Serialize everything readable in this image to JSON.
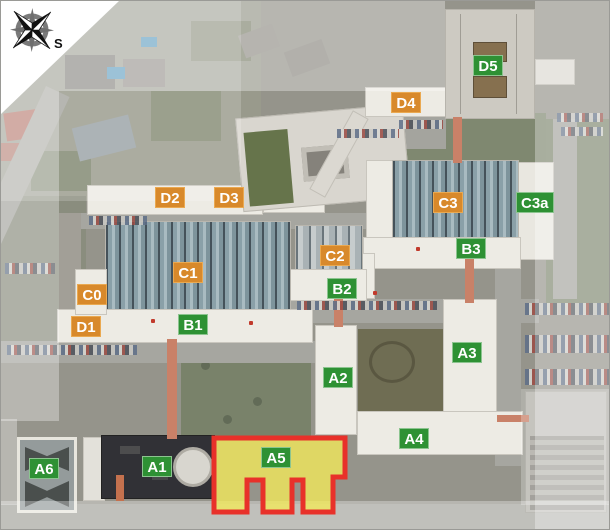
{
  "map": {
    "type": "campus-aerial-plan",
    "compass": {
      "south_label": "S"
    },
    "label_colors": {
      "orange": "#D8892B",
      "green": "#2E9134"
    },
    "highlight": {
      "building_id": "A5",
      "fill": "#F2E96B",
      "border": "#E8312A"
    },
    "labels": [
      {
        "text": "D2",
        "style": "orange",
        "x": 154,
        "y": 186
      },
      {
        "text": "D3",
        "style": "orange",
        "x": 213,
        "y": 186
      },
      {
        "text": "D4",
        "style": "orange",
        "x": 390,
        "y": 91
      },
      {
        "text": "D5",
        "style": "green",
        "x": 472,
        "y": 54
      },
      {
        "text": "C0",
        "style": "orange",
        "x": 76,
        "y": 283
      },
      {
        "text": "C1",
        "style": "orange",
        "x": 172,
        "y": 261
      },
      {
        "text": "C2",
        "style": "orange",
        "x": 319,
        "y": 244
      },
      {
        "text": "C3",
        "style": "orange",
        "x": 432,
        "y": 191
      },
      {
        "text": "C3a",
        "style": "green",
        "x": 515,
        "y": 191
      },
      {
        "text": "D1",
        "style": "orange",
        "x": 70,
        "y": 315
      },
      {
        "text": "B1",
        "style": "green",
        "x": 177,
        "y": 313
      },
      {
        "text": "B2",
        "style": "green",
        "x": 326,
        "y": 277
      },
      {
        "text": "B3",
        "style": "green",
        "x": 455,
        "y": 237
      },
      {
        "text": "A1",
        "style": "green",
        "x": 141,
        "y": 455
      },
      {
        "text": "A2",
        "style": "green",
        "x": 322,
        "y": 366
      },
      {
        "text": "A3",
        "style": "green",
        "x": 451,
        "y": 341
      },
      {
        "text": "A4",
        "style": "green",
        "x": 398,
        "y": 427
      },
      {
        "text": "A5",
        "style": "green",
        "x": 260,
        "y": 446
      },
      {
        "text": "A6",
        "style": "green",
        "x": 28,
        "y": 457
      }
    ]
  }
}
